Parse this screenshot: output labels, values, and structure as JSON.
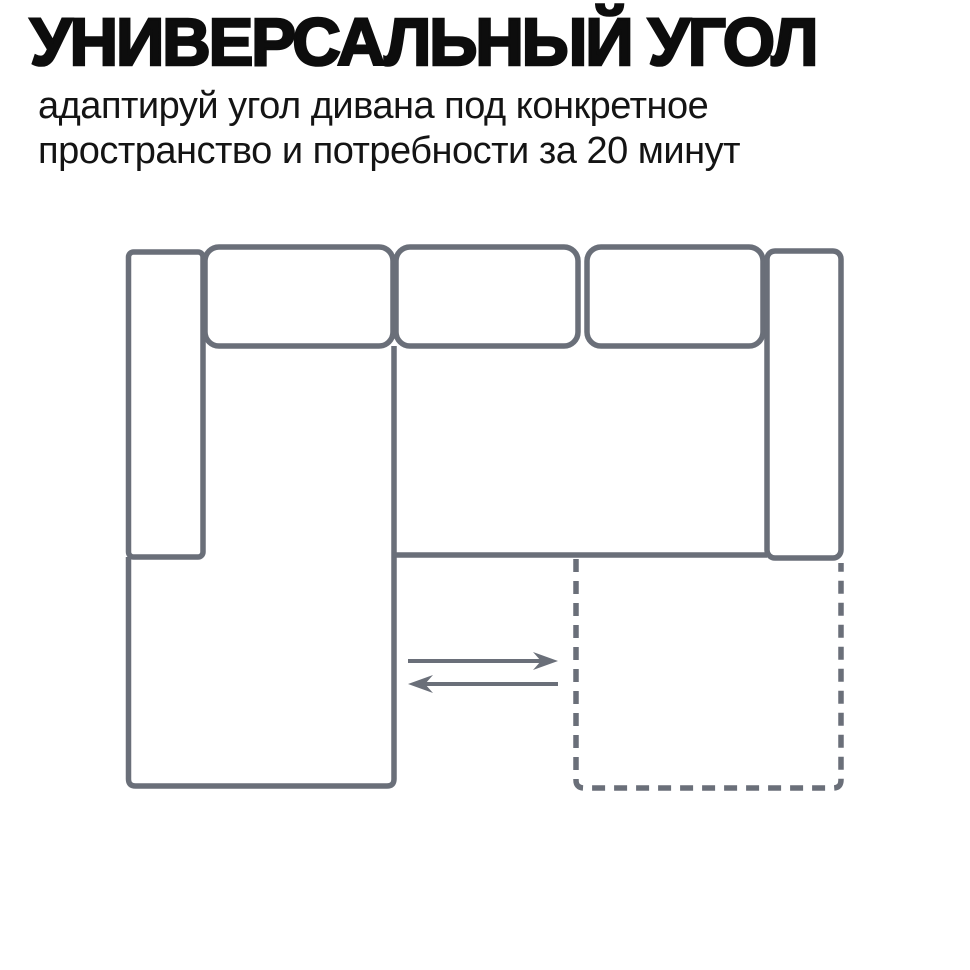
{
  "page": {
    "background_color": "#ffffff"
  },
  "header": {
    "title": "УНИВЕРСАЛЬНЫЙ УГОЛ",
    "subtitle_line1": "адаптируй угол дивана под конкретное",
    "subtitle_line2": "пространство и потребности за 20 минут",
    "text_color": "#0d0d0d"
  },
  "diagram": {
    "stroke_color": "#6a6f79",
    "parts": [
      "left-armrest",
      "back-cushion-1",
      "back-cushion-2",
      "back-cushion-3",
      "right-armrest",
      "corner-chaise",
      "seat-front-edge",
      "alternate-corner-position-dashed",
      "move-right-arrow",
      "move-left-arrow"
    ]
  }
}
